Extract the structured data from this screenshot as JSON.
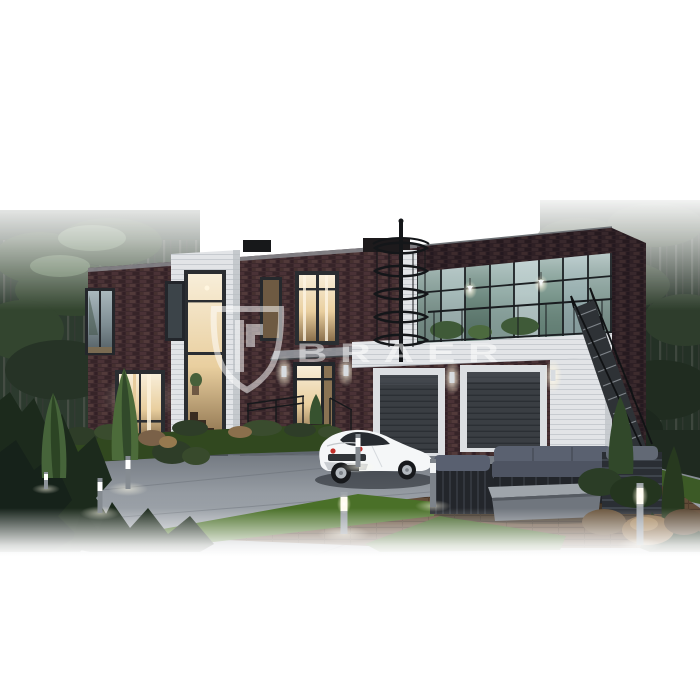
{
  "watermark": {
    "brand": "BRAER",
    "logo": "shield-monogram-icon",
    "opacity": "0.85"
  },
  "palette": {
    "sky": "#ffffff",
    "brick": "#3f2a2e",
    "brick_dark": "#2c1e23",
    "siding_white": "#e3e5e8",
    "window_warm": "#f1dfc0",
    "glass_reflection": "#8fa7a2",
    "garage_door": "#383c41",
    "driveway": "#8b9198",
    "grass": "#3f6128",
    "deck_wood": "#66503a",
    "forest": "#27352a",
    "car_body": "#f5f7f8",
    "taillight_red": "#c2302a",
    "furniture_gray": "#596070",
    "bollard_light": "#ffffff"
  }
}
